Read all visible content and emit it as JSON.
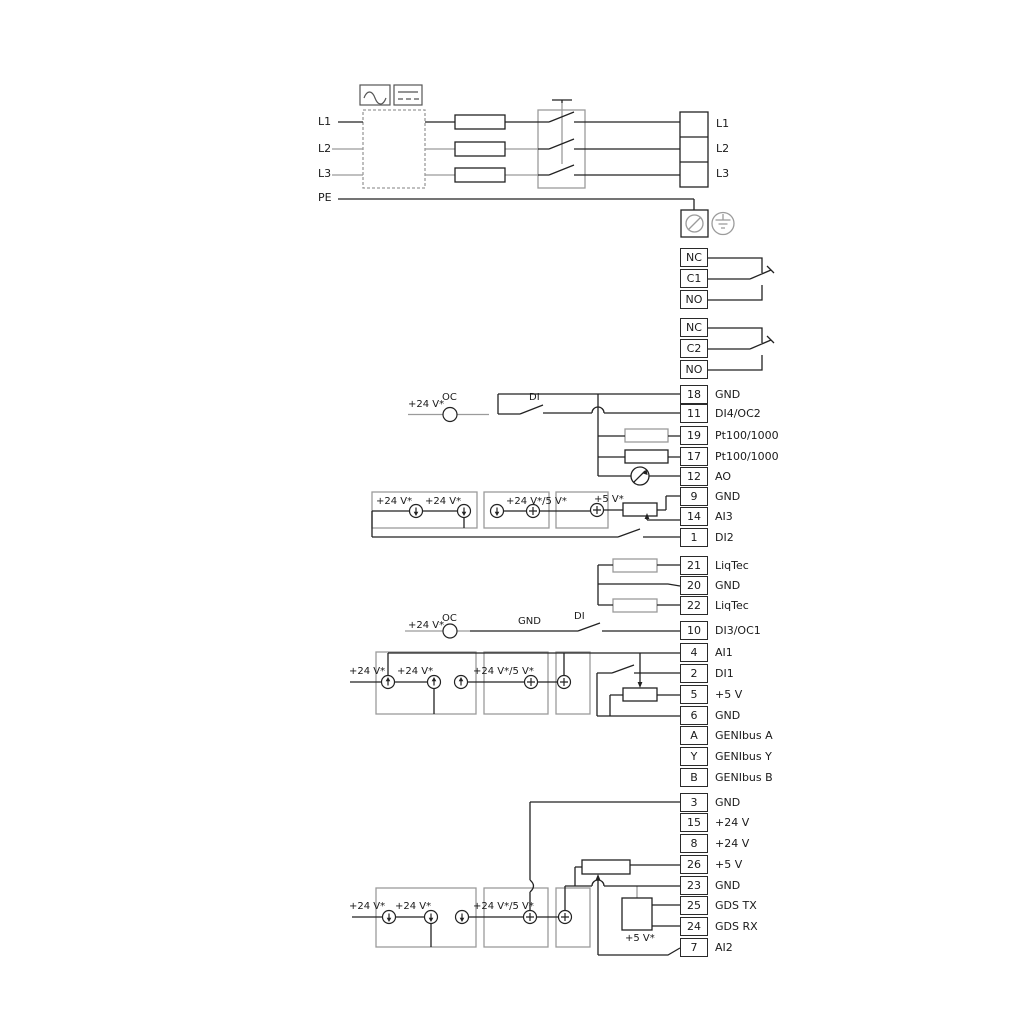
{
  "power": {
    "left_labels": [
      "L1",
      "L2",
      "L3",
      "PE"
    ],
    "right_labels": [
      "L1",
      "L2",
      "L3"
    ]
  },
  "relays": [
    {
      "terminals": [
        "NC",
        "C1",
        "NO"
      ]
    },
    {
      "terminals": [
        "NC",
        "C2",
        "NO"
      ]
    }
  ],
  "io_terminals": {
    "group1": [
      {
        "id": "18",
        "label": "GND"
      },
      {
        "id": "11",
        "label": "DI4/OC2"
      },
      {
        "id": "19",
        "label": "Pt100/1000"
      },
      {
        "id": "17",
        "label": "Pt100/1000"
      },
      {
        "id": "12",
        "label": "AO"
      },
      {
        "id": "9",
        "label": "GND"
      },
      {
        "id": "14",
        "label": "AI3"
      },
      {
        "id": "1",
        "label": "DI2"
      }
    ],
    "liqtec": [
      {
        "id": "21",
        "label": "LiqTec"
      },
      {
        "id": "20",
        "label": "GND"
      },
      {
        "id": "22",
        "label": "LiqTec"
      }
    ],
    "di3": {
      "id": "10",
      "label": "DI3/OC1"
    },
    "group2": [
      {
        "id": "4",
        "label": "AI1"
      },
      {
        "id": "2",
        "label": "DI1"
      },
      {
        "id": "5",
        "label": "+5 V"
      },
      {
        "id": "6",
        "label": "GND"
      },
      {
        "id": "A",
        "label": "GENIbus A"
      },
      {
        "id": "Y",
        "label": "GENIbus Y"
      },
      {
        "id": "B",
        "label": "GENIbus B"
      }
    ],
    "group3": [
      {
        "id": "3",
        "label": "GND"
      },
      {
        "id": "15",
        "label": "+24 V"
      },
      {
        "id": "8",
        "label": "+24 V"
      },
      {
        "id": "26",
        "label": "+5 V"
      },
      {
        "id": "23",
        "label": "GND"
      },
      {
        "id": "25",
        "label": "GDS TX"
      },
      {
        "id": "24",
        "label": "GDS RX"
      },
      {
        "id": "7",
        "label": "AI2"
      }
    ]
  },
  "ann": {
    "v24": "+24 V*",
    "v24_5": "+24 V*/5 V*",
    "v5": "+5 V*",
    "oc": "OC",
    "di": "DI",
    "gnd": "GND"
  },
  "colors": {
    "wire_black": "#222222",
    "wire_gray": "#9b9b9b"
  }
}
